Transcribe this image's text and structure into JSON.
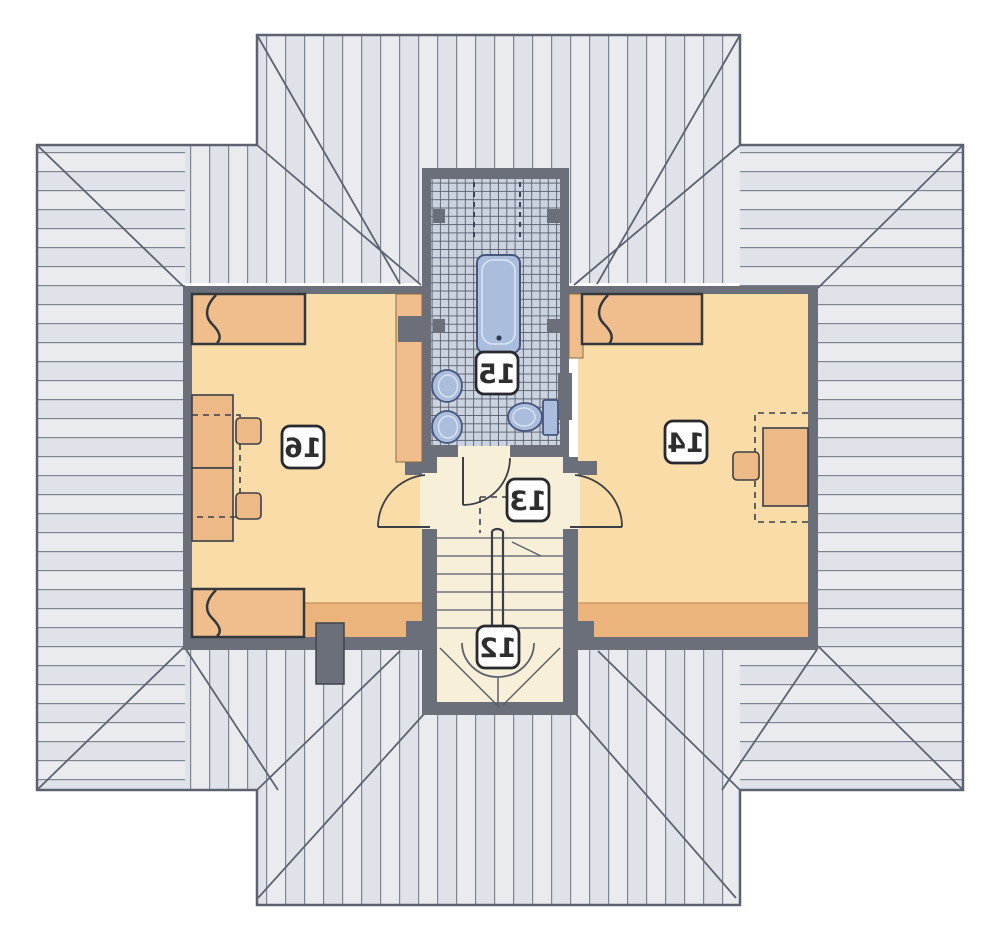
{
  "plan": {
    "type": "attic-floor-plan",
    "mirrored_text": true,
    "rooms": [
      {
        "id": "staircase",
        "label": "12"
      },
      {
        "id": "hallway",
        "label": "13"
      },
      {
        "id": "bedroom-right",
        "label": "14"
      },
      {
        "id": "bathroom",
        "label": "15"
      },
      {
        "id": "bedroom-left",
        "label": "16"
      }
    ],
    "fixtures": [
      "bathtub",
      "washbasin",
      "washbasin",
      "toilet"
    ],
    "furniture": [
      "bed",
      "bed",
      "bed",
      "desk",
      "desk",
      "desk",
      "chair",
      "chair",
      "chair",
      "wardrobe",
      "wardrobe"
    ],
    "features": [
      "hip-roof-plan",
      "stair-arrow",
      "door-swings",
      "chimney",
      "low-headroom-bands",
      "knee-wall-dashed-lines"
    ],
    "colors": {
      "floor": "#F9DCA8",
      "floor_low_headroom": "#EBB47D",
      "hall_floor": "#F8EFD9",
      "wall": "#6A6F79",
      "roof_light": "#E9EBEF",
      "roof_shade": "#DFE2E8",
      "roof_line": "#7E8592",
      "outline": "#5C6270",
      "tile": "#CBD3E1",
      "tile_line": "#575E6E",
      "fixture_blue": "#AABDDD",
      "fixture_blue_dark": "#46557A",
      "furniture_tan": "#EFBE8C"
    }
  }
}
